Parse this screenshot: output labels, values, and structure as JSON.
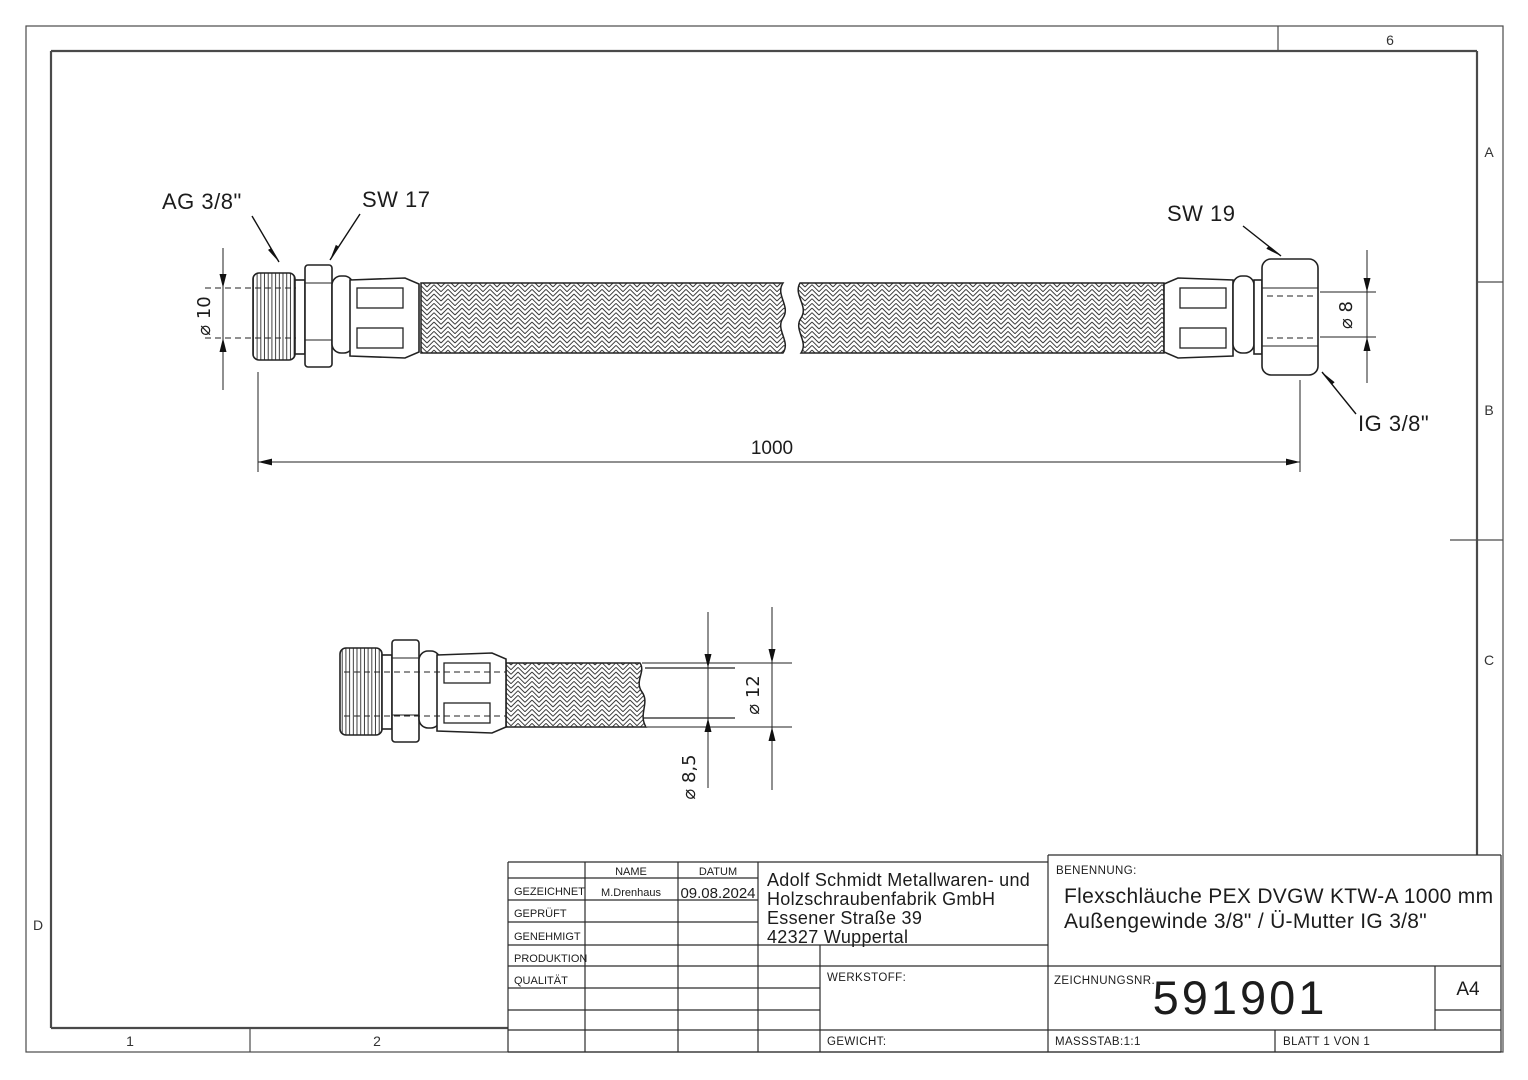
{
  "zones": {
    "top": "6",
    "right_a": "A",
    "right_b": "B",
    "right_c": "C",
    "left_d": "D",
    "bottom_1": "1",
    "bottom_2": "2"
  },
  "top_view": {
    "label_ag": "AG 3/8\"",
    "label_sw17": "SW 17",
    "label_sw19": "SW 19",
    "label_ig": "IG 3/8\"",
    "dim_length": "1000",
    "dim_diameter_left": "⌀ 10",
    "dim_diameter_right": "⌀ 8"
  },
  "detail_view": {
    "dim_outer": "⌀ 12",
    "dim_inner": "⌀ 8,5"
  },
  "title_block": {
    "approval_table": {
      "col_name": "NAME",
      "col_date": "DATUM",
      "rows": [
        {
          "label": "GEZEICHNET",
          "name": "M.Drenhaus",
          "date": "09.08.2024"
        },
        {
          "label": "GEPRÜFT",
          "name": "",
          "date": ""
        },
        {
          "label": "GENEHMIGT",
          "name": "",
          "date": ""
        },
        {
          "label": "PRODUKTION",
          "name": "",
          "date": ""
        },
        {
          "label": "QUALITÄT",
          "name": "",
          "date": ""
        }
      ]
    },
    "company": {
      "line1": "Adolf Schmidt Metallwaren- und",
      "line2": "Holzschraubenfabrik GmbH",
      "line3": "Essener Straße 39",
      "line4": "42327 Wuppertal"
    },
    "benennung_label": "BENENNUNG:",
    "title_line1": "Flexschläuche PEX DVGW KTW-A 1000 mm",
    "title_line2": "Außengewinde 3/8\" / Ü-Mutter IG 3/8\"",
    "werkstoff_label": "WERKSTOFF:",
    "gewicht_label": "GEWICHT:",
    "zeichnungsnr_label": "ZEICHNUNGSNR.",
    "drawing_number": "591901",
    "paper_format": "A4",
    "massstab": "MASSSTAB:1:1",
    "blatt": "BLATT 1 VON 1"
  }
}
